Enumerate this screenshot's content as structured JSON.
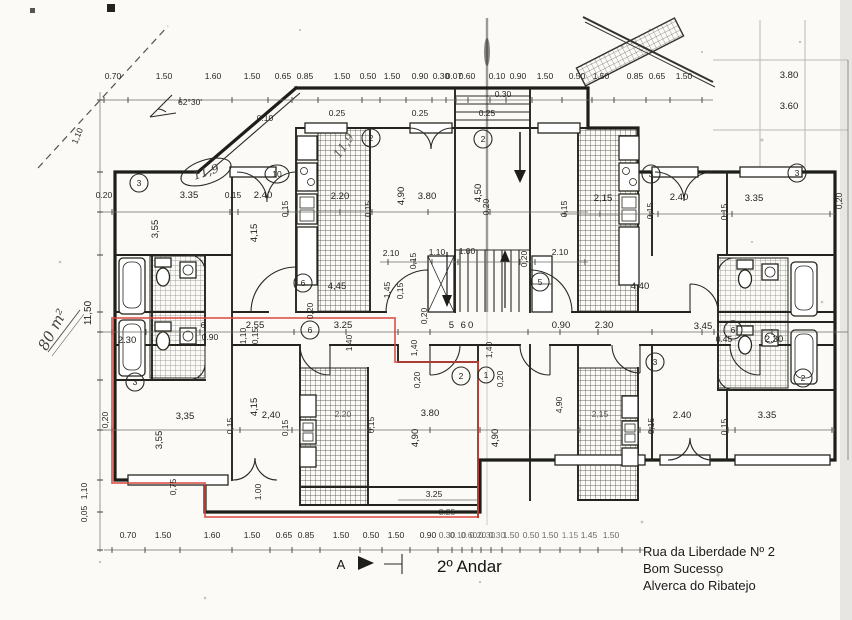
{
  "doc": {
    "floor_label": "2º Andar",
    "address": [
      "Rua da Liberdade Nº 2",
      "Bom Sucesso",
      "Alverca do Ribatejo"
    ],
    "section_marker": "A"
  },
  "notes": {
    "area_hand": "80 m²",
    "scale_dim": "11,50",
    "angle": "62°30'",
    "room_area_1": "11,9",
    "room_area_2": "11,9"
  },
  "colors": {
    "accent": "#d8473c",
    "ink": "#1e1e1a"
  },
  "rooms": [
    "3",
    "10",
    "2",
    "2",
    "3",
    "3",
    "6",
    "5",
    "6",
    "6",
    "3",
    "2",
    "1",
    "3",
    "2"
  ],
  "dims": {
    "top": [
      "0.70",
      "1.50",
      "1.60",
      "1.50",
      "0.65",
      "0.85",
      "1.50",
      "0.50",
      "1.50",
      "0.90",
      "0.30",
      "0.07",
      "0.60",
      "0.10",
      "0.90",
      "1.50",
      "0.50",
      "1.50",
      "0.85",
      "0.65",
      "1.50"
    ],
    "top_sub": [
      "0.30",
      "0.25",
      "0.25",
      "0.25",
      "0.10"
    ],
    "site": [
      "3.80",
      "3.60"
    ],
    "left_edge": [
      "1,10",
      "1,10",
      "0,05"
    ],
    "ul": [
      "0.20",
      "3.35",
      "0.15",
      "2.40",
      "0,15",
      "3,55",
      "4,15"
    ],
    "uc": [
      "2.20",
      "0,15",
      "3.80",
      "0,20",
      "4,90",
      "4,50",
      "2.10",
      "0,15",
      "1.10",
      "1.00",
      "0,20",
      "2.10",
      "1,45",
      "0,15"
    ],
    "ur": [
      "0,15",
      "2,15",
      "0,15",
      "2.40",
      "0,15",
      "3.35",
      "0,20"
    ],
    "hall": [
      "4,45",
      "4.40",
      "0,20"
    ],
    "mid": [
      "2.30",
      "6",
      "2.55",
      "0.90",
      "1,10",
      "0,15",
      "3.25",
      "5 60",
      "0.90",
      "2.30",
      "3.45",
      "0.45",
      "2.30",
      "1,40",
      "1,40",
      "1,40",
      "0,20"
    ],
    "ll": [
      "0,20",
      "3,35",
      "0,15",
      "2,40",
      "0,15",
      "3,55",
      "4,15"
    ],
    "lc": [
      "2.20",
      "0,15",
      "3.80",
      "0,20",
      "0,20",
      "4,90",
      "4,90",
      "3.25",
      "3.25",
      "1.00",
      "0,75"
    ],
    "lr": [
      "2,15",
      "0,15",
      "2.40",
      "0,15",
      "3.35",
      "4,90"
    ],
    "bottom": [
      "0.70",
      "1.50",
      "1.60",
      "1.50",
      "0.65",
      "0.85",
      "1.50",
      "0.50",
      "1.50",
      "0.90",
      "0.30",
      "0.10",
      "0.60",
      "0.20",
      "0.30",
      "0.30",
      "1.50",
      "0.50",
      "1.50",
      "1.15",
      "1.45",
      "1.50"
    ]
  }
}
